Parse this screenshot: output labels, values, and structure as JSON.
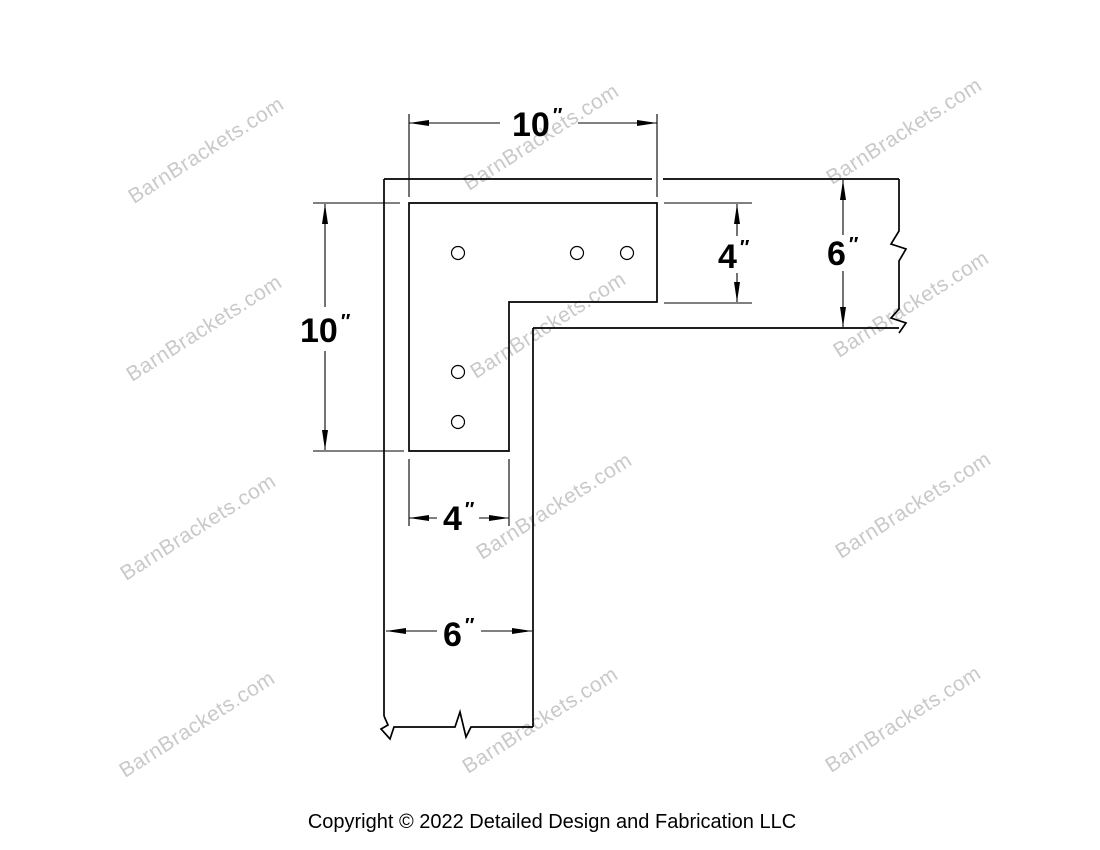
{
  "watermark": {
    "text": "BarnBrackets.com",
    "color": "#c9c9c9"
  },
  "drawing": {
    "description": "L-shaped flush corner bracket with five bolt holes, shown installed over two timber beams joined at a right angle; beam ends drawn with break lines",
    "line_color": "#000000",
    "hole_count": 5
  },
  "dimensions": {
    "top_width": {
      "value": "10",
      "unit": "″"
    },
    "left_height": {
      "value": "10",
      "unit": "″"
    },
    "right_leg_width": {
      "value": "4",
      "unit": "″"
    },
    "right_beam_depth": {
      "value": "6",
      "unit": "″"
    },
    "bottom_leg_width": {
      "value": "4",
      "unit": "″"
    },
    "bottom_beam_depth": {
      "value": "6",
      "unit": "″"
    }
  },
  "footer": {
    "copyright": "Copyright © 2022 Detailed Design and Fabrication LLC"
  }
}
